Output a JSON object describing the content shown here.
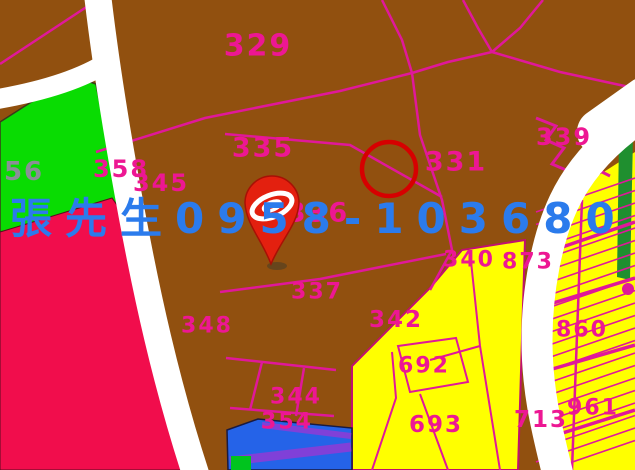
{
  "map": {
    "kind": "cadastral-parcel-map",
    "contact_overlay": {
      "label": "張先生0958-103680",
      "color": "#2B7BEC"
    },
    "parcel_labels": [
      {
        "number": "329",
        "x": 258,
        "y": 46,
        "size": 30
      },
      {
        "number": "335",
        "x": 263,
        "y": 148,
        "size": 27
      },
      {
        "number": "331",
        "x": 456,
        "y": 162,
        "size": 27
      },
      {
        "number": "339",
        "x": 564,
        "y": 137,
        "size": 24
      },
      {
        "number": "356",
        "x": 14,
        "y": 172,
        "size": 26,
        "color": "#8A8F96"
      },
      {
        "number": "358",
        "x": 121,
        "y": 169,
        "size": 24
      },
      {
        "number": "345",
        "x": 161,
        "y": 183,
        "size": 24
      },
      {
        "number": "336",
        "x": 318,
        "y": 213,
        "size": 27
      },
      {
        "number": "337",
        "x": 317,
        "y": 292,
        "size": 22
      },
      {
        "number": "348",
        "x": 207,
        "y": 326,
        "size": 22
      },
      {
        "number": "342",
        "x": 396,
        "y": 320,
        "size": 23
      },
      {
        "number": "340",
        "x": 469,
        "y": 260,
        "size": 22
      },
      {
        "number": "873",
        "x": 528,
        "y": 262,
        "size": 22
      },
      {
        "number": "860",
        "x": 582,
        "y": 330,
        "size": 22
      },
      {
        "number": "961",
        "x": 593,
        "y": 408,
        "size": 22
      },
      {
        "number": "692",
        "x": 424,
        "y": 366,
        "size": 22
      },
      {
        "number": "693",
        "x": 436,
        "y": 425,
        "size": 23
      },
      {
        "number": "713",
        "x": 541,
        "y": 420,
        "size": 23
      },
      {
        "number": "344",
        "x": 296,
        "y": 397,
        "size": 22
      },
      {
        "number": "354",
        "x": 287,
        "y": 422,
        "size": 22
      }
    ],
    "annotations": {
      "highlight_circle": {
        "color": "#D60000"
      },
      "location_pin": {
        "icon": "map-pin-icon",
        "color": "#E3200F"
      }
    },
    "colors": {
      "parcel_brown": "#91500F",
      "parcel_green": "#09DC02",
      "parcel_crimson": "#F10D4C",
      "parcel_yellow": "#FFFF00",
      "parcel_blue": "#2563E8",
      "stripe_purple": "#8040D8",
      "small_green": "#00C41E",
      "green_strip": "#1F8F2F",
      "road_white": "#FFFFFF",
      "boundary_line": "#E0189A",
      "boundary_label": "#ED1793"
    }
  }
}
